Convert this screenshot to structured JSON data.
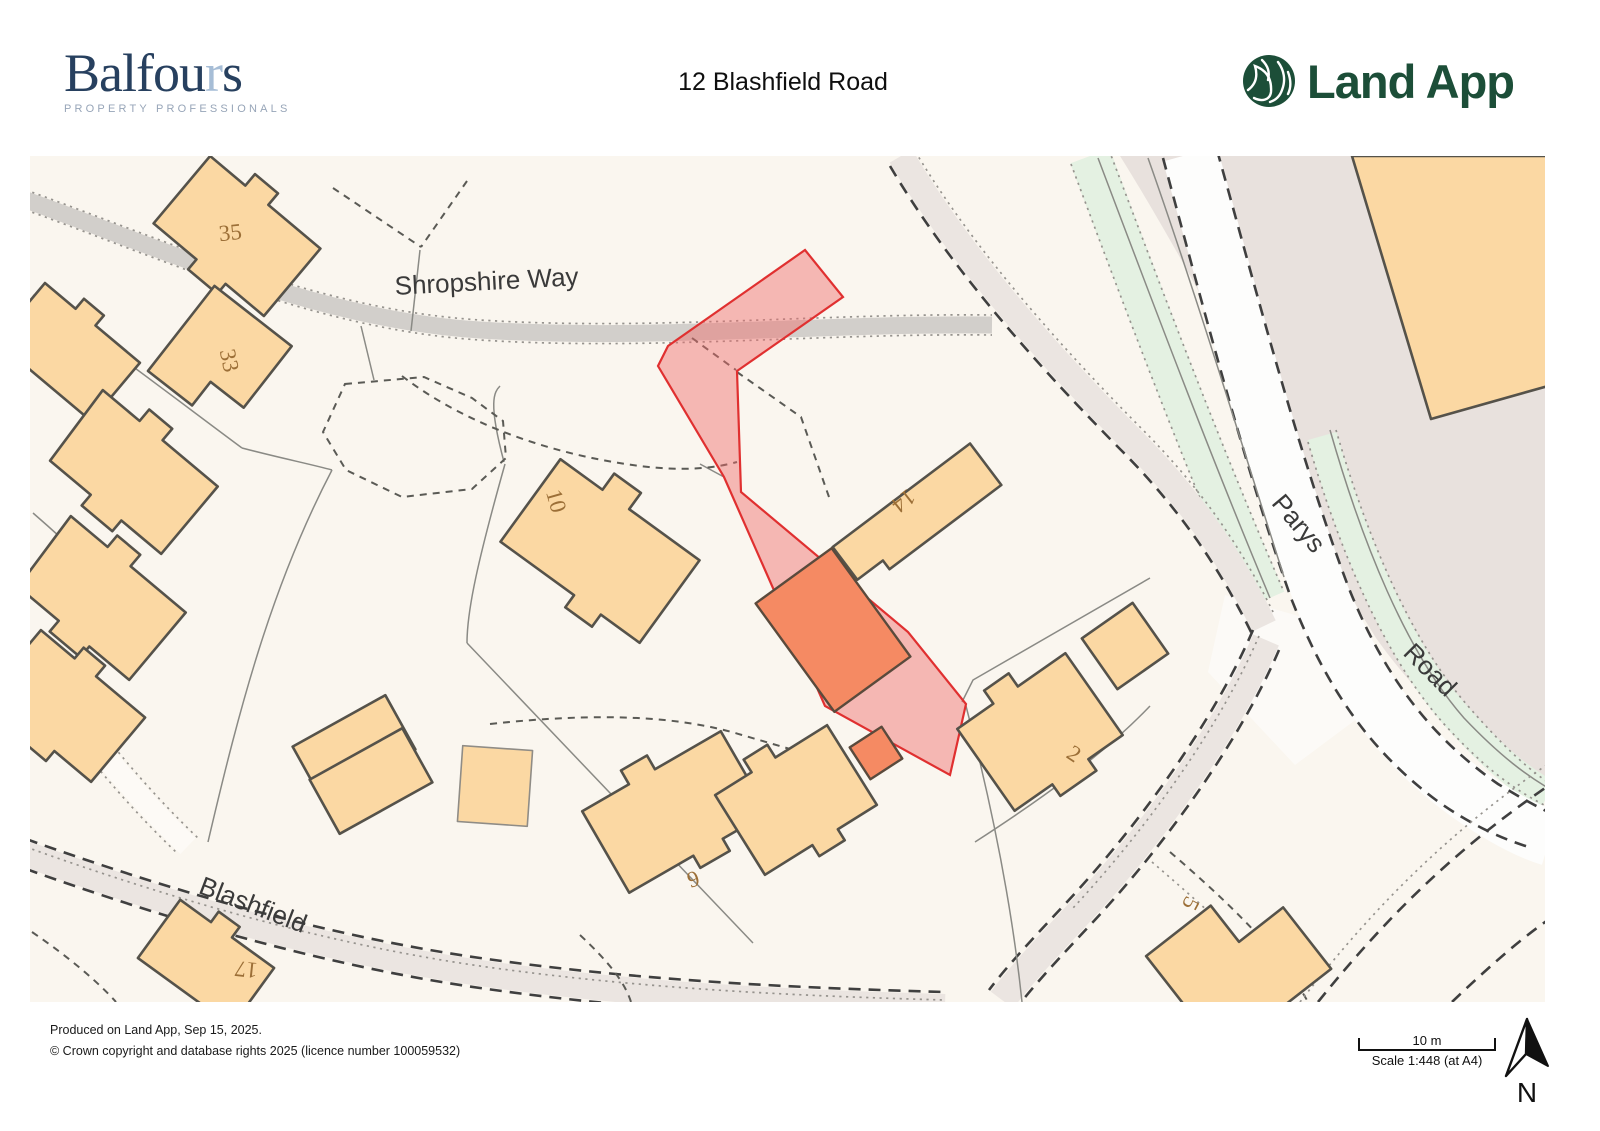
{
  "header": {
    "balfours_pre": "Balfou",
    "balfours_accent": "r",
    "balfours_post": "s",
    "balfours_tagline": "PROPERTY PROFESSIONALS",
    "title": "12 Blashfield Road",
    "landapp": "Land App"
  },
  "map": {
    "streets": {
      "shropshire_way": "Shropshire Way",
      "parys": "Parys",
      "road": "Road",
      "blashfield": "Blashfield"
    },
    "house_numbers": {
      "n35": "35",
      "n33": "33",
      "n10": "10",
      "n14": "14",
      "n2": "2",
      "n6": "6",
      "n17": "17",
      "n5": "5"
    }
  },
  "footer": {
    "produced": "Produced on Land App, Sep 15, 2025.",
    "copyright": "© Crown copyright and database rights 2025 (licence number 100059532)",
    "scale_value": "10 m",
    "scale_text": "Scale 1:448 (at A4)",
    "north": "N"
  },
  "theme": {
    "map-bg": "#faf6ef",
    "building-fill": "#fbd8a3",
    "building-stroke": "#55524a",
    "highlight-fill": "#f58a63",
    "parcel-red": "#ef6a6a",
    "parcel-red-stroke": "#e03030",
    "road-gray": "#d2cfcb",
    "path-beige": "#ebe5e1",
    "road-white": "#fdfdfc",
    "verge-green": "#e4f1e2",
    "area-beige": "#e8e1dd",
    "number-brown": "#9c6f37",
    "balfours-navy": "#27405f",
    "landapp-green": "#1c4e38"
  }
}
